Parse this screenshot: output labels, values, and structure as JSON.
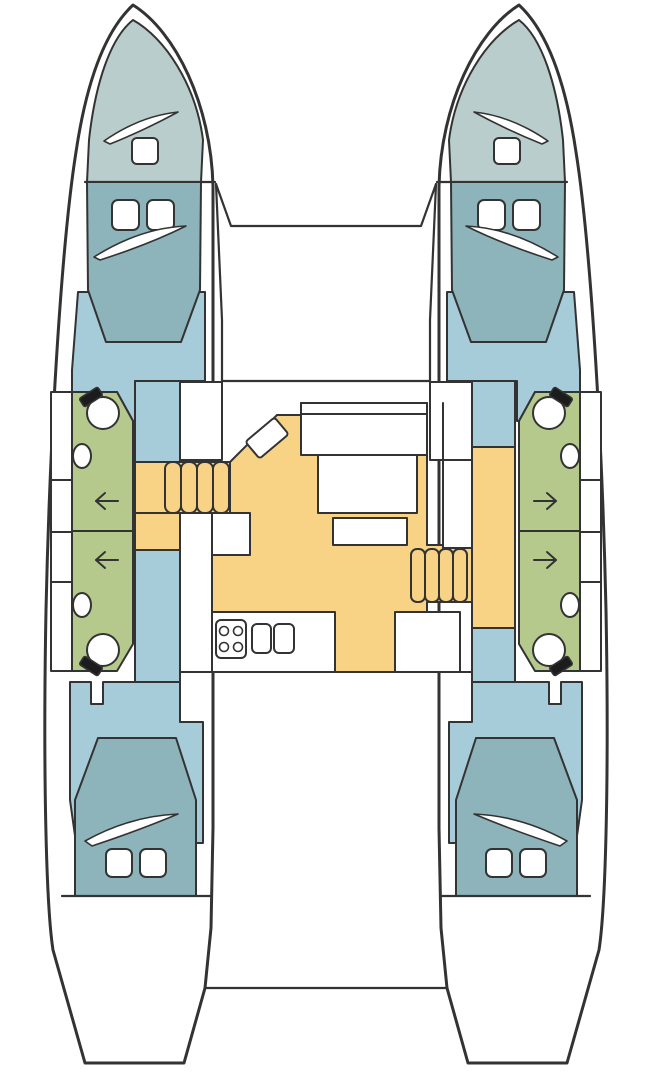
{
  "title": "Catamaran yacht deck and accommodation floor plan (top view)",
  "colors": {
    "outline": "#333333",
    "hull_white": "#ffffff",
    "bow_locker_teal": "#b9cdcc",
    "berth_teal": "#8db4ba",
    "cabin_blue": "#a6cbd9",
    "heads_green": "#b6c98c",
    "floor_yellow": "#f8d285",
    "fixture_black": "#1c1c1c"
  },
  "legend": {
    "bow_area": "forepeak locker with deck hatch",
    "forward_berth": "forward double berth with pillows",
    "heads": "bathroom (toilet + wash basin) with door arrow",
    "corridor": "hull companionway",
    "stairs": "companionway steps to hull",
    "salon": "salon with dinette table and seats",
    "nav_seat": "chart / nav seat",
    "galley": "galley with 4-burner stove and double sink",
    "aft_cabin": "aft double berth cabin",
    "cockpit": "aft cockpit",
    "transom": "aft crossbeam and sugar-scoop steps"
  },
  "fixtures": {
    "toilets": 4,
    "wash_basins": 4,
    "door_arrows": 4,
    "stove_burners": 4,
    "galley_sinks": 2,
    "deck_hatches": 2,
    "berth_pillows": 8,
    "stairways": 2,
    "cabins": 4
  }
}
